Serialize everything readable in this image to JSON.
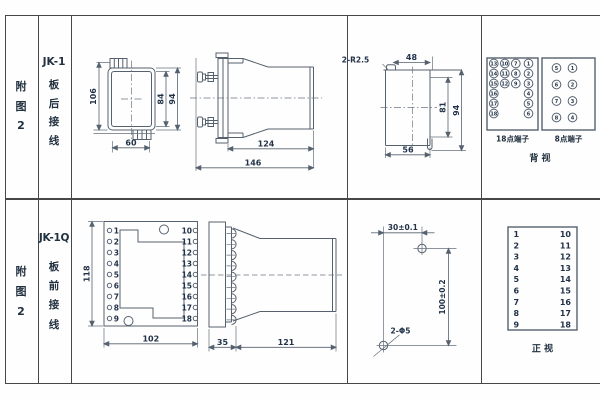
{
  "left_labels": {
    "r1_fig": [
      "附",
      "图",
      "2"
    ],
    "r1_model": "JK-1",
    "r1_wiring": [
      "板",
      "后",
      "接",
      "线"
    ],
    "r2_fig": [
      "附",
      "图",
      "2"
    ],
    "r2_model": "JK-1Q",
    "r2_wiring": [
      "板",
      "前",
      "接",
      "线"
    ]
  },
  "top_row": {
    "front_view": {
      "h_total": "106",
      "h_inner": "84",
      "h_outer": "94",
      "w": "60"
    },
    "side_view": {
      "body": "124",
      "total": "146"
    },
    "cutout": {
      "r": "2-R2.5",
      "top": "48",
      "inner_h": "81",
      "outer_h": "94",
      "bottom": "56"
    },
    "t18": {
      "label": "18点端子",
      "c1": [
        "13",
        "14",
        "15",
        "16",
        "17",
        "18"
      ],
      "c2": [
        "10",
        "11",
        "12"
      ],
      "c3": [
        "7",
        "8",
        "9"
      ],
      "c4": [
        "1",
        "2",
        "3",
        "4",
        "5",
        "6"
      ]
    },
    "t8": {
      "label": "8点端子",
      "c1": [
        "5",
        "6",
        "7",
        "8"
      ],
      "c2": [
        "1",
        "2",
        "3",
        "4"
      ]
    },
    "rear_label": "背  视"
  },
  "bottom_row": {
    "front_view": {
      "h": "118",
      "w": "102",
      "left": [
        "1",
        "2",
        "3",
        "4",
        "5",
        "6",
        "7",
        "8",
        "9"
      ],
      "right": [
        "10",
        "11",
        "12",
        "13",
        "14",
        "15",
        "16",
        "17",
        "18"
      ]
    },
    "side_view": {
      "front": "35",
      "body": "121"
    },
    "drill": {
      "dx": "30±0.1",
      "dy": "100±0.2",
      "holes": "2-Φ5"
    },
    "table": {
      "left": [
        "1",
        "2",
        "3",
        "4",
        "5",
        "6",
        "7",
        "8",
        "9"
      ],
      "right": [
        "10",
        "11",
        "12",
        "13",
        "14",
        "15",
        "16",
        "17",
        "18"
      ],
      "label": "正  视"
    }
  }
}
